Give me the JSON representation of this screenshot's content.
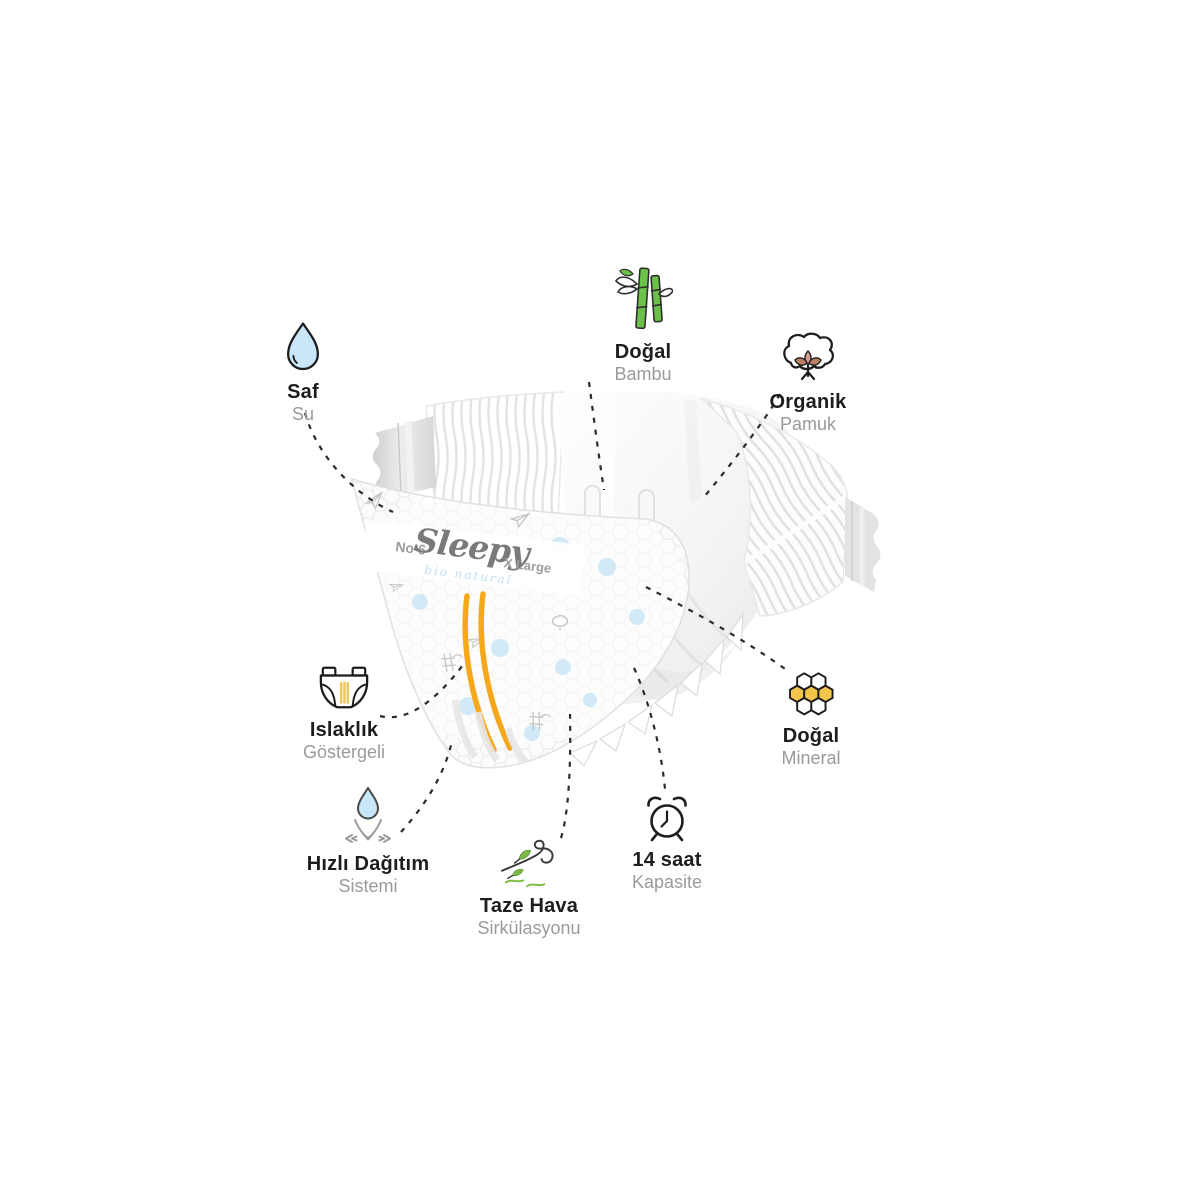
{
  "product": {
    "brand": "Sleepy",
    "sub_brand": "bio natural",
    "size_no": "No 6",
    "size_label": "X Large"
  },
  "features": [
    {
      "id": "saf-su",
      "title": "Saf",
      "subtitle": "Su",
      "icon": "water-drop-icon"
    },
    {
      "id": "dogal-bambu",
      "title": "Doğal",
      "subtitle": "Bambu",
      "icon": "bamboo-icon"
    },
    {
      "id": "organik-pamuk",
      "title": "Organik",
      "subtitle": "Pamuk",
      "icon": "cotton-icon"
    },
    {
      "id": "islaklik-gostergeli",
      "title": "Islaklık",
      "subtitle": "Göstergeli",
      "icon": "diaper-icon"
    },
    {
      "id": "dogal-mineral",
      "title": "Doğal",
      "subtitle": "Mineral",
      "icon": "honeycomb-icon"
    },
    {
      "id": "hizli-dagitim",
      "title": "Hızlı Dağıtım",
      "subtitle": "Sistemi",
      "icon": "absorb-arrows-icon"
    },
    {
      "id": "taze-hava",
      "title": "Taze Hava",
      "subtitle": "Sirkülasyonu",
      "icon": "wind-leaf-icon"
    },
    {
      "id": "on-dort-saat",
      "title": "14 saat",
      "subtitle": "Kapasite",
      "icon": "alarm-clock-icon"
    }
  ],
  "colors": {
    "accent_orange": "#F7A71C",
    "bamboo_green": "#6CC149",
    "leaf_green": "#7CBB44",
    "honey_yellow": "#F2C54B",
    "drop_blue": "#C9E7F8",
    "dot_blue": "#C7E4F6",
    "cotton_brown": "#BC8066",
    "title_text": "#1D1D1F",
    "subtitle_text": "#9A9A9A",
    "line_dark": "#2B2B2B",
    "logo_gray": "#7A7A7A"
  }
}
